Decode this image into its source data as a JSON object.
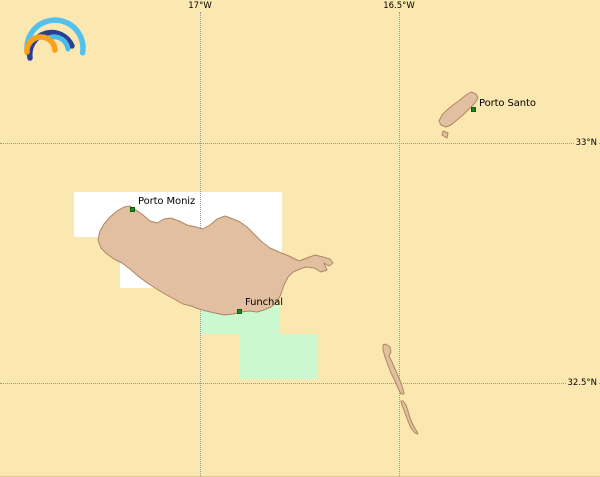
{
  "map": {
    "colors": {
      "sea": "#FBE7B0",
      "land": "#E3BFA2",
      "land_border": "#AD8663",
      "tile_white": "#FFFFFF",
      "tile_green": "#CBF8CE",
      "grid": "#999999",
      "label": "#000000",
      "marker": "#1A8A1A"
    },
    "meridians": [
      {
        "label": "17°W",
        "x": 200
      },
      {
        "label": "16.5°W",
        "x": 399
      }
    ],
    "parallels": [
      {
        "label": "33°N",
        "y": 143
      },
      {
        "label": "32.5°N",
        "y": 383
      }
    ],
    "places": [
      {
        "name": "Porto Moniz",
        "marker": [
          132,
          209
        ],
        "label": [
          138,
          196
        ]
      },
      {
        "name": "Funchal",
        "marker": [
          239,
          311
        ],
        "label": [
          245,
          297
        ]
      },
      {
        "name": "Porto Santo",
        "marker": [
          473,
          109
        ],
        "label": [
          479,
          98
        ]
      }
    ]
  },
  "logo": {
    "name": "rainbow-arcs",
    "colors": {
      "outer_arc": "#53C1EF",
      "navy_arc": "#2B3E94",
      "inner_arc": "#47BBEE",
      "orange_arc": "#F9A11B"
    }
  }
}
